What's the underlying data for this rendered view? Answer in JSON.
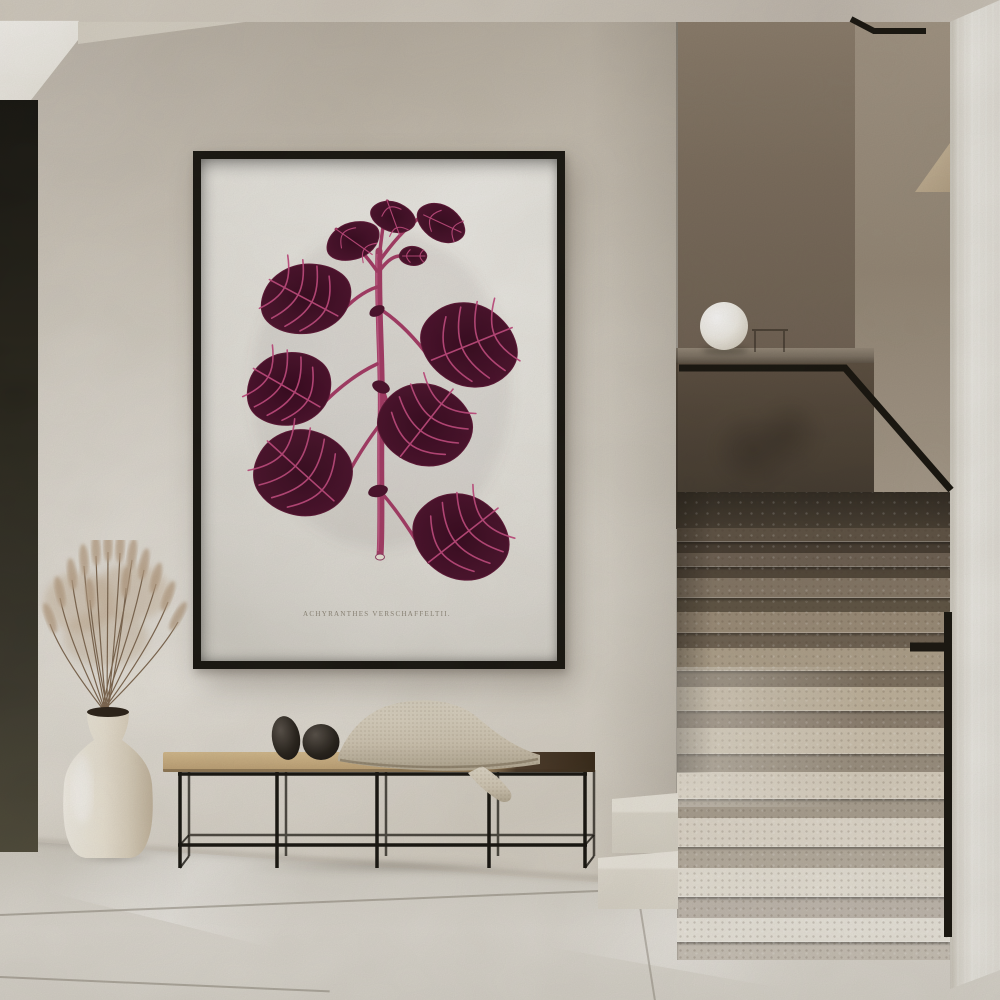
{
  "scene": {
    "type": "interior-photo",
    "artwork": {
      "caption": "ACHYRANTHES VERSCHAFFELTII.",
      "frame_color": "#17150f",
      "paper_color": "#eae8e2",
      "leaf_color": "#4a0f2b",
      "leaf_core_color": "#36081e",
      "vein_color": "#c2497e",
      "stem_color": "#a63a66"
    },
    "palette": {
      "ceiling": "#cfc8bd",
      "wall": "#d7d1c6",
      "doorway": "#23211a",
      "stairwell_wall": "#77695a",
      "parapet": "#4a4034",
      "rail": "#16130d",
      "step_dark": "#5e5244",
      "step_light": "#ebe7de",
      "near_wall": "#e7e4dd",
      "floor": "#d8d4cb",
      "vase": "#eee8da",
      "dried_grass": "#b59d82",
      "bench_wood": "#c9ae80",
      "bench_dark_wood": "#4e3c2b",
      "blanket": "#d5ccba",
      "pebbles": "#1d1915",
      "lamp": "#f4f1ea"
    }
  }
}
